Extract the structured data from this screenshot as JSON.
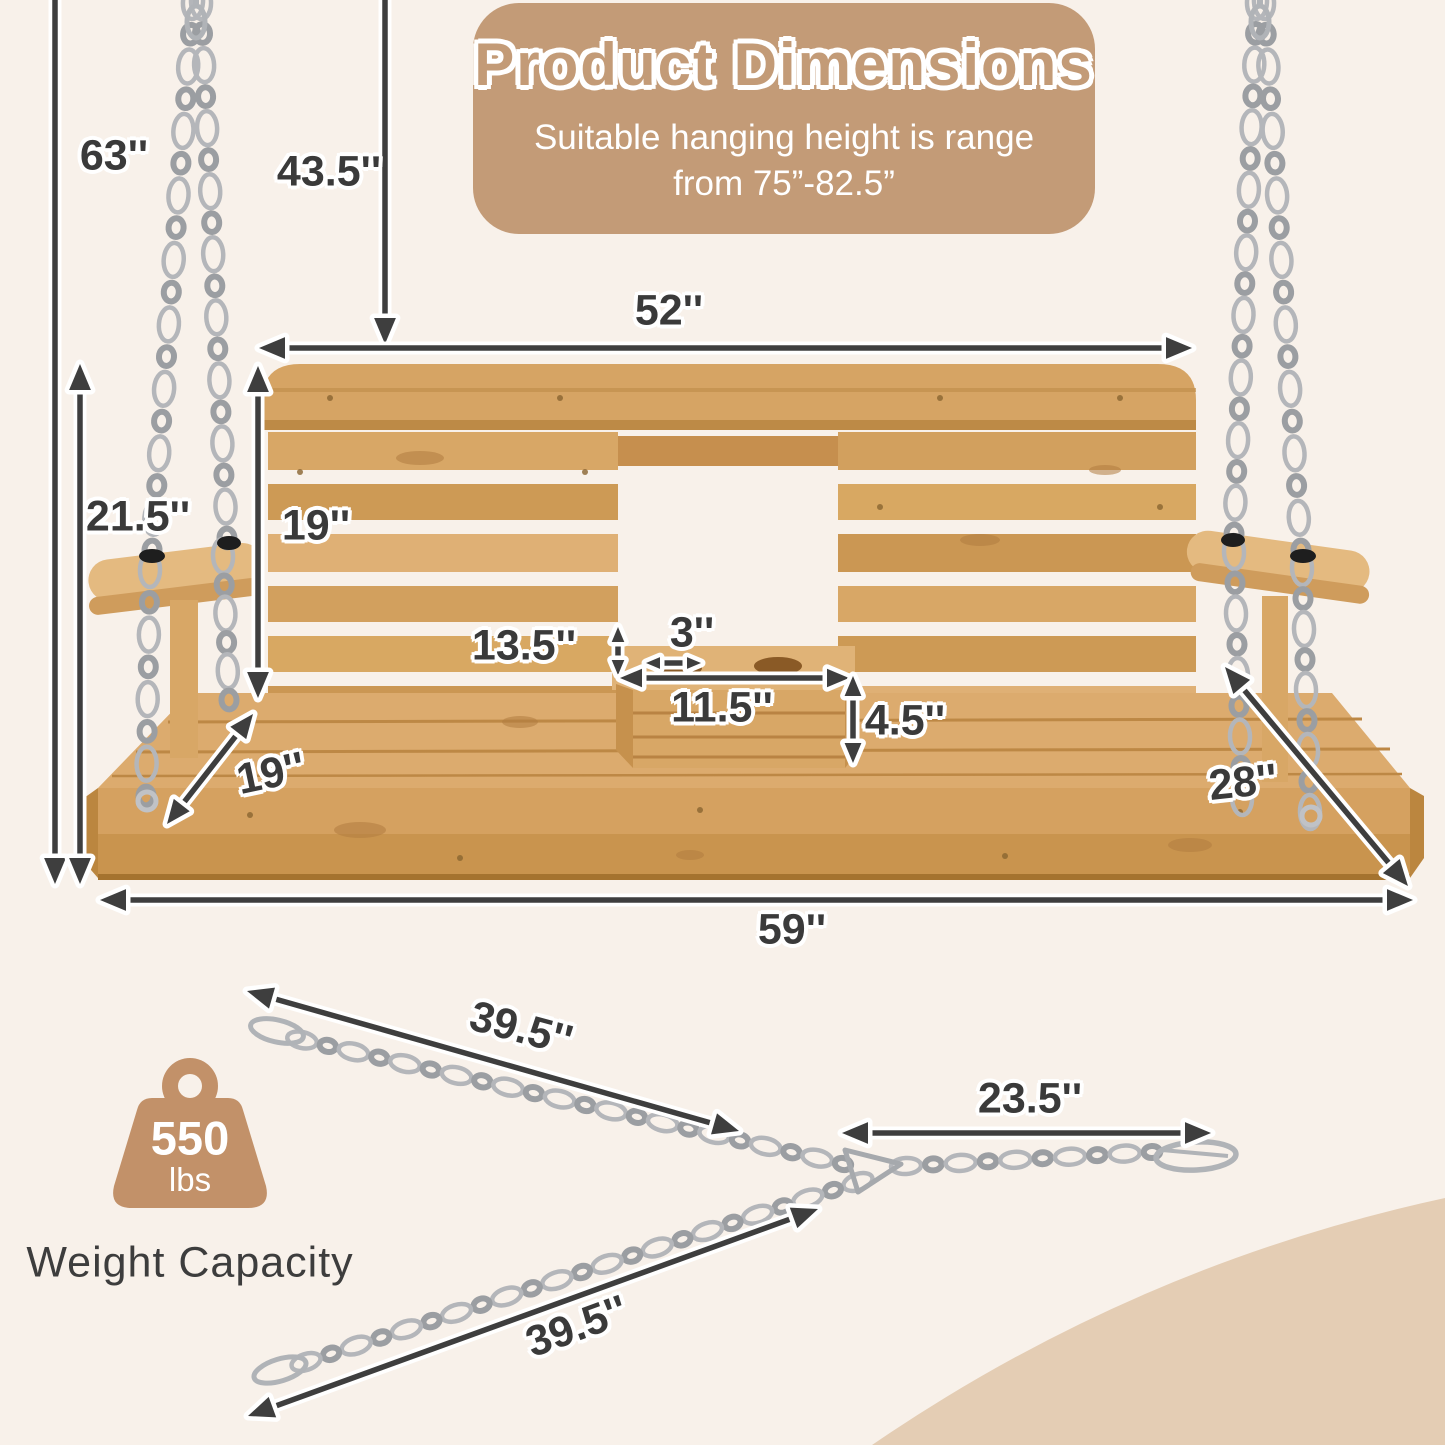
{
  "title": "Product Dimensions",
  "subtitle": {
    "line1": "Suitable hanging height is range",
    "line2": "from 75”-82.5”"
  },
  "dimensions": {
    "total_height": "63''",
    "top_to_seat_back": "43.5''",
    "backrest_width": "52''",
    "side_height": "21.5''",
    "backrest_height": "19''",
    "console_to_seat": "13.5''",
    "cup_hole_diameter": "3''",
    "console_width": "11.5''",
    "console_depth": "4.5''",
    "seat_depth": "19''",
    "overall_depth": "28''",
    "overall_width": "59''",
    "chain_top_length": "39.5''",
    "chain_right_length": "23.5''",
    "chain_bottom_length": "39.5''"
  },
  "weight_capacity": {
    "value": "550",
    "unit": "lbs",
    "label": "Weight Capacity"
  },
  "colors": {
    "background": "#f8f1ea",
    "banner": "#c39b77",
    "corner_accent": "#e4cdb4",
    "arrow": "#3e3e3e",
    "wood": "#d9a868",
    "chain": "#b4b6ba",
    "weight_icon": "#c29169"
  }
}
